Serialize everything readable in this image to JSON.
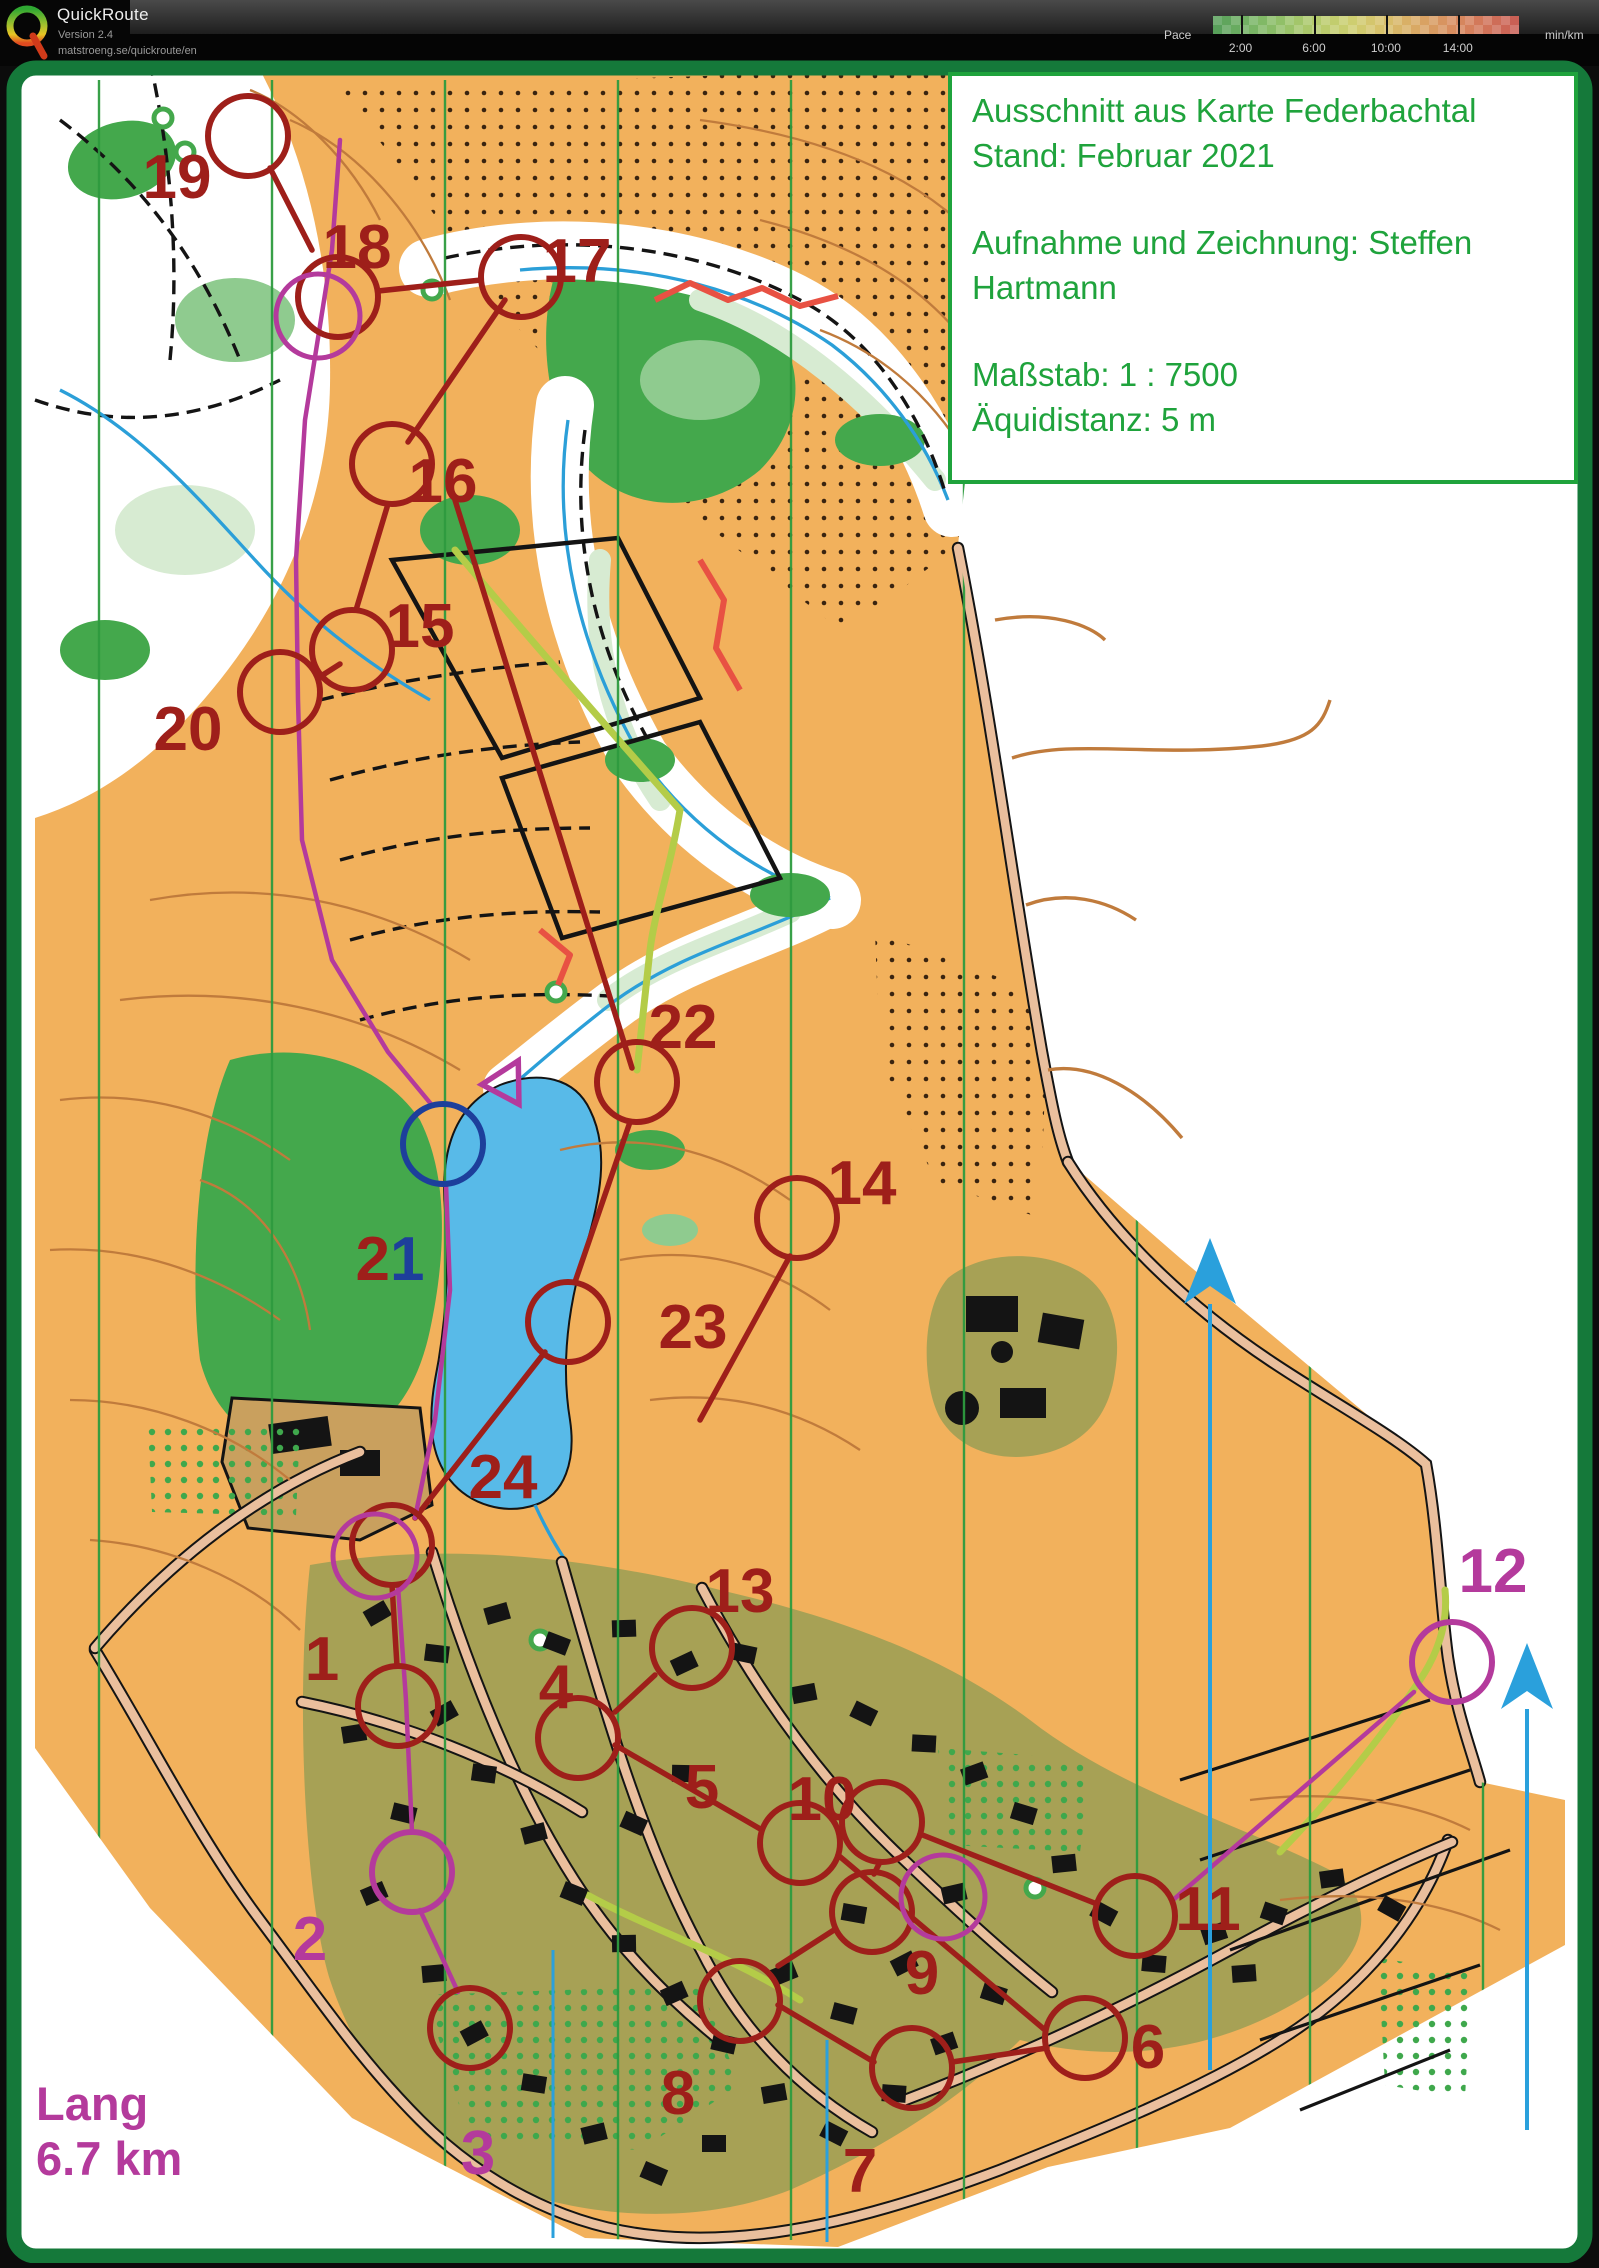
{
  "header": {
    "app_name": "QuickRoute",
    "version": "Version 2.4",
    "url": "matstroeng.se/quickroute/en",
    "legend": {
      "label": "Pace",
      "unit": "min/km",
      "ticks": [
        {
          "label": "2:00",
          "f": 0.09
        },
        {
          "label": "6:00",
          "f": 0.33
        },
        {
          "label": "10:00",
          "f": 0.565
        },
        {
          "label": "14:00",
          "f": 0.8
        }
      ],
      "gradient_stops": [
        "#58a05a",
        "#76b465",
        "#94c168",
        "#b4cb6c",
        "#cdcf70",
        "#d8c16b",
        "#d9a964",
        "#d88f5f",
        "#d3775a",
        "#c96055"
      ]
    }
  },
  "map": {
    "colors": {
      "orange": "#f2b15c",
      "olive": "#a7a155",
      "tan": "#c9a05e",
      "forest": "#44a84c",
      "forestL": "#8fcb8f",
      "forestP": "#d7ebd2",
      "lake": "#58bae8",
      "stream": "#2b9fd8",
      "contour": "#c07b3c",
      "road": "#eabf9d",
      "lane": "#b4cc48",
      "frame": "#15793a",
      "info": "#1fa33c",
      "red": "#9e1f1a",
      "magenta": "#b43a9c",
      "navy": "#1d3f9b",
      "northline": "#2e9b3f",
      "cyan": "#2aa0dc",
      "route": "#e85143",
      "dots": "#3a2410"
    },
    "info_box": {
      "lines": [
        "Ausschnitt aus Karte Federbachtal",
        "Stand: Februar 2021",
        "",
        "Aufnahme und Zeichnung: Steffen",
        "Hartmann",
        "",
        "Maßstab: 1 : 7500",
        "Äquidistanz: 5 m"
      ]
    },
    "course_label": {
      "name": "Lang",
      "distance": "6.7 km"
    },
    "controls": [
      {
        "n": "1",
        "x": 322,
        "y": 1658,
        "color": "red",
        "cx": 398,
        "cy": 1706,
        "ccolor": "red"
      },
      {
        "n": "2",
        "x": 310,
        "y": 1938,
        "color": "magenta",
        "cx": 412,
        "cy": 1872,
        "ccolor": "magenta"
      },
      {
        "n": "3",
        "x": 478,
        "y": 2152,
        "color": "magenta",
        "cx": 470,
        "cy": 2028,
        "ccolor": "red"
      },
      {
        "n": "4",
        "x": 556,
        "y": 1686,
        "color": "red",
        "cx": 578,
        "cy": 1738,
        "ccolor": "red"
      },
      {
        "n": "5",
        "x": 702,
        "y": 1786,
        "color": "red",
        "cx": 800,
        "cy": 1843,
        "ccolor": "red"
      },
      {
        "n": "6",
        "x": 1148,
        "y": 2046,
        "color": "red",
        "cx": 1085,
        "cy": 2038,
        "ccolor": "red"
      },
      {
        "n": "7",
        "x": 860,
        "y": 2170,
        "color": "red",
        "cx": 912,
        "cy": 2068,
        "ccolor": "red"
      },
      {
        "n": "8",
        "x": 678,
        "y": 2092,
        "color": "red",
        "cx": 740,
        "cy": 2001,
        "ccolor": "red"
      },
      {
        "n": "9",
        "x": 922,
        "y": 1972,
        "color": "red",
        "cx": 872,
        "cy": 1912,
        "ccolor": "red"
      },
      {
        "n": "10",
        "x": 822,
        "y": 1798,
        "color": "red",
        "cx": 882,
        "cy": 1822,
        "ccolor": "red"
      },
      {
        "n": "11",
        "x": 1208,
        "y": 1908,
        "color": "red",
        "cx": 1135,
        "cy": 1916,
        "ccolor": "red"
      },
      {
        "n": "12",
        "x": 1493,
        "y": 1570,
        "color": "magenta",
        "cx": 1452,
        "cy": 1662,
        "ccolor": "magenta"
      },
      {
        "n": "13",
        "x": 740,
        "y": 1590,
        "color": "red",
        "cx": 692,
        "cy": 1648,
        "ccolor": "red"
      },
      {
        "n": "14",
        "x": 862,
        "y": 1182,
        "color": "red",
        "cx": 797,
        "cy": 1218,
        "ccolor": "red"
      },
      {
        "n": "15",
        "x": 420,
        "y": 625,
        "color": "red",
        "cx": 352,
        "cy": 650,
        "ccolor": "red"
      },
      {
        "n": "16",
        "x": 443,
        "y": 480,
        "color": "red",
        "cx": 392,
        "cy": 464,
        "ccolor": "red"
      },
      {
        "n": "17",
        "x": 577,
        "y": 260,
        "color": "red",
        "cx": 521,
        "cy": 277,
        "ccolor": "red"
      },
      {
        "n": "18",
        "x": 357,
        "y": 246,
        "color": "red",
        "cx": 338,
        "cy": 297,
        "ccolor": "red"
      },
      {
        "n": "19",
        "x": 177,
        "y": 176,
        "color": "red",
        "cx": 248,
        "cy": 136,
        "ccolor": "red"
      },
      {
        "n": "20",
        "x": 188,
        "y": 728,
        "color": "red",
        "cx": 280,
        "cy": 692,
        "ccolor": "red"
      },
      {
        "n": "21",
        "x": 390,
        "y": 1258,
        "color": "navy",
        "parts": [
          {
            "t": "2",
            "color": "red"
          },
          {
            "t": "1",
            "color": "navy"
          }
        ],
        "cx": 443,
        "cy": 1144,
        "ccolor": "navy"
      },
      {
        "n": "22",
        "x": 683,
        "y": 1026,
        "color": "red",
        "cx": 637,
        "cy": 1082,
        "ccolor": "red"
      },
      {
        "n": "23",
        "x": 693,
        "y": 1326,
        "color": "red",
        "cx": 568,
        "cy": 1322,
        "ccolor": "red"
      },
      {
        "n": "24",
        "x": 503,
        "y": 1476,
        "color": "red",
        "cx": 392,
        "cy": 1545,
        "ccolor": "red"
      }
    ],
    "extra_circles": [
      {
        "x": 375,
        "y": 1556,
        "color": "magenta"
      },
      {
        "x": 943,
        "y": 1897,
        "color": "magenta"
      },
      {
        "x": 318,
        "y": 316,
        "color": "magenta"
      }
    ],
    "start_triangle": {
      "x": 507,
      "y": 1082,
      "rot": 28,
      "color": "magenta"
    },
    "course_legs": [
      {
        "color": "red",
        "pts": [
          [
            505,
            300
          ],
          [
            408,
            442
          ]
        ]
      },
      {
        "color": "red",
        "pts": [
          [
            388,
            504
          ],
          [
            356,
            610
          ]
        ]
      },
      {
        "color": "red",
        "pts": [
          [
            455,
            500
          ],
          [
            632,
            1068
          ]
        ]
      },
      {
        "color": "red",
        "pts": [
          [
            340,
            664
          ],
          [
            318,
            678
          ]
        ]
      },
      {
        "color": "red",
        "pts": [
          [
            378,
            291
          ],
          [
            481,
            280
          ]
        ]
      },
      {
        "color": "red",
        "pts": [
          [
            270,
            168
          ],
          [
            312,
            250
          ]
        ]
      },
      {
        "color": "red",
        "pts": [
          [
            630,
            1122
          ],
          [
            575,
            1282
          ]
        ]
      },
      {
        "color": "red",
        "pts": [
          [
            545,
            1352
          ],
          [
            415,
            1518
          ]
        ]
      },
      {
        "color": "red",
        "pts": [
          [
            392,
            1585
          ],
          [
            397,
            1666
          ]
        ]
      },
      {
        "color": "red",
        "pts": [
          [
            790,
            1256
          ],
          [
            700,
            1420
          ]
        ]
      },
      {
        "color": "red",
        "pts": [
          [
            655,
            1675
          ],
          [
            615,
            1712
          ]
        ]
      },
      {
        "color": "red",
        "pts": [
          [
            615,
            1745
          ],
          [
            762,
            1830
          ]
        ]
      },
      {
        "color": "red",
        "pts": [
          [
            838,
            1855
          ],
          [
            1045,
            2030
          ]
        ]
      },
      {
        "color": "red",
        "pts": [
          [
            1047,
            2048
          ],
          [
            952,
            2062
          ]
        ]
      },
      {
        "color": "red",
        "pts": [
          [
            874,
            2062
          ],
          [
            778,
            2005
          ]
        ]
      },
      {
        "color": "red",
        "pts": [
          [
            778,
            1966
          ],
          [
            834,
            1930
          ]
        ]
      },
      {
        "color": "red",
        "pts": [
          [
            874,
            1874
          ],
          [
            880,
            1862
          ]
        ]
      },
      {
        "color": "red",
        "pts": [
          [
            920,
            1834
          ],
          [
            1097,
            1904
          ]
        ]
      },
      {
        "color": "magenta",
        "w": 4.5,
        "pts": [
          [
            340,
            140
          ],
          [
            332,
            250
          ],
          [
            305,
            420
          ],
          [
            296,
            560
          ],
          [
            298,
            700
          ],
          [
            302,
            840
          ],
          [
            332,
            960
          ],
          [
            388,
            1052
          ],
          [
            431,
            1104
          ]
        ]
      },
      {
        "color": "magenta",
        "w": 4.5,
        "pts": [
          [
            446,
            1184
          ],
          [
            450,
            1290
          ],
          [
            435,
            1420
          ],
          [
            415,
            1518
          ]
        ]
      },
      {
        "color": "magenta",
        "w": 4.5,
        "pts": [
          [
            398,
            1586
          ],
          [
            406,
            1700
          ],
          [
            412,
            1832
          ]
        ]
      },
      {
        "color": "magenta",
        "w": 4.5,
        "pts": [
          [
            420,
            1910
          ],
          [
            458,
            1992
          ]
        ]
      },
      {
        "color": "magenta",
        "w": 4.5,
        "pts": [
          [
            1173,
            1900
          ],
          [
            1414,
            1692
          ]
        ]
      }
    ],
    "route_track": [
      {
        "pts": [
          [
            655,
            300
          ],
          [
            690,
            283
          ],
          [
            728,
            300
          ],
          [
            762,
            288
          ],
          [
            800,
            306
          ],
          [
            838,
            296
          ]
        ]
      },
      {
        "pts": [
          [
            700,
            560
          ],
          [
            724,
            600
          ],
          [
            716,
            648
          ],
          [
            740,
            690
          ]
        ]
      },
      {
        "pts": [
          [
            540,
            930
          ],
          [
            570,
            955
          ],
          [
            558,
            985
          ]
        ]
      }
    ],
    "north_lines": {
      "x_positions": [
        99,
        272,
        445,
        618,
        791,
        964,
        1137,
        1310,
        1483
      ],
      "cyan_segments": [
        [
          553,
          1950,
          2238
        ],
        [
          827,
          2040,
          2242
        ]
      ]
    },
    "north_arrows": [
      {
        "x": 1210,
        "y": 1290,
        "shaft_to": 2070
      },
      {
        "x": 1527,
        "y": 1695,
        "shaft_to": 2130
      }
    ]
  }
}
